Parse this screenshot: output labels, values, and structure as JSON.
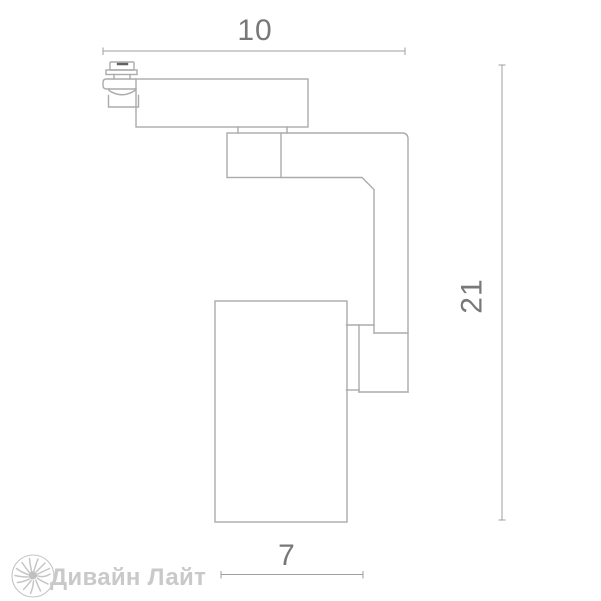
{
  "dimension_labels": {
    "top": "10",
    "right": "21",
    "bottom": "7"
  },
  "watermark": {
    "brand_name": "Дивайн Лайт",
    "icon": "sun-burst"
  },
  "colors": {
    "background": "#ffffff",
    "fixture_outline": "#ababab",
    "dimension_line": "#9f9f9f",
    "dimension_text": "#787878",
    "knob_slot": "#616161",
    "watermark": "#c9c9c9"
  }
}
